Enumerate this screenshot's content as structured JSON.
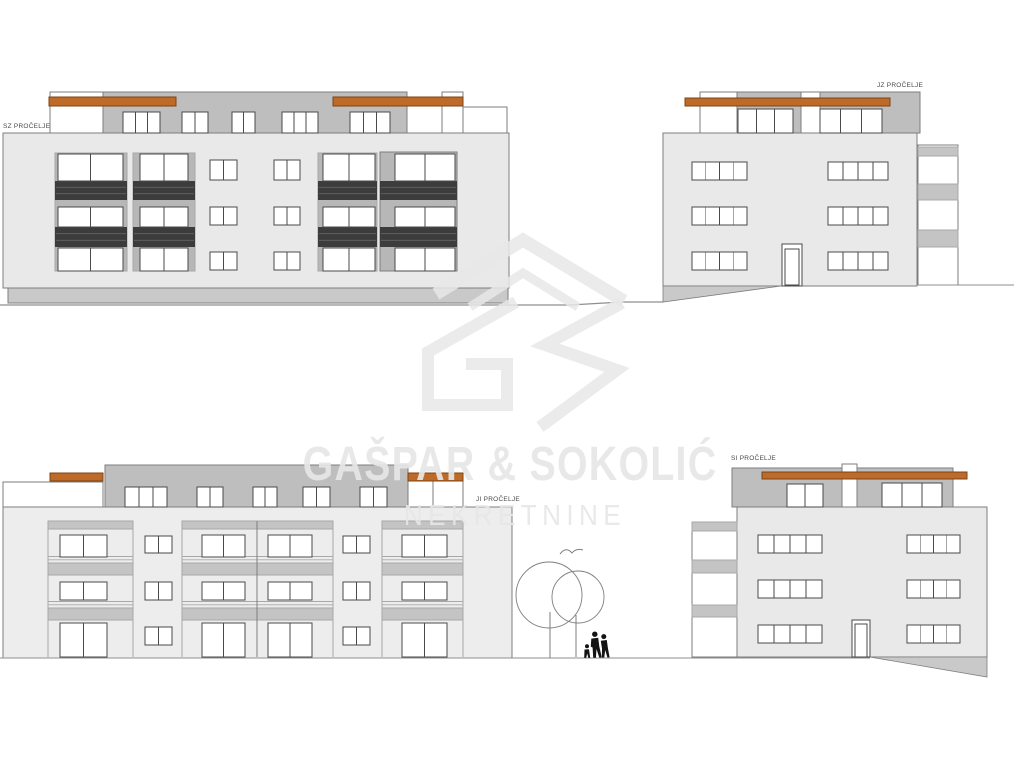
{
  "document": {
    "type": "building-elevation-drawing"
  },
  "elevations": [
    {
      "id": "sz",
      "label": "SZ PROČELJE",
      "position": "top-left"
    },
    {
      "id": "jz",
      "label": "JZ PROČELJE",
      "position": "top-right"
    },
    {
      "id": "ji",
      "label": "JI PROČELJE",
      "position": "bottom-left"
    },
    {
      "id": "si",
      "label": "SI PROČELJE",
      "position": "bottom-right"
    }
  ],
  "watermark": {
    "company": "GAŠPAR & SOKOLIĆ",
    "tagline": "NEKRETNINE",
    "logo": "gs-house-logo"
  },
  "colors": {
    "white": "#FFFFFF",
    "wall": "#E9E9E9",
    "wall_alt": "#EDEDED",
    "attic_wall": "#BEBEBE",
    "fascia_orange": "#BE6A28",
    "fascia_edge": "#7C4414",
    "panel_gray": "#B7B7B7",
    "slab_gray": "#C4C4C4",
    "base_gray": "#C9C9C9",
    "railing_dark": "#3C3C3C",
    "railing_texture": "#646464",
    "frame": "#4A4A4A",
    "outline": "#7E7E7E",
    "outline_light": "#A8A8A8",
    "ground": "#8F8F8F",
    "silhouette": "#141414",
    "label_text": "#4A4A4A",
    "watermark": "#E7E7E7"
  }
}
